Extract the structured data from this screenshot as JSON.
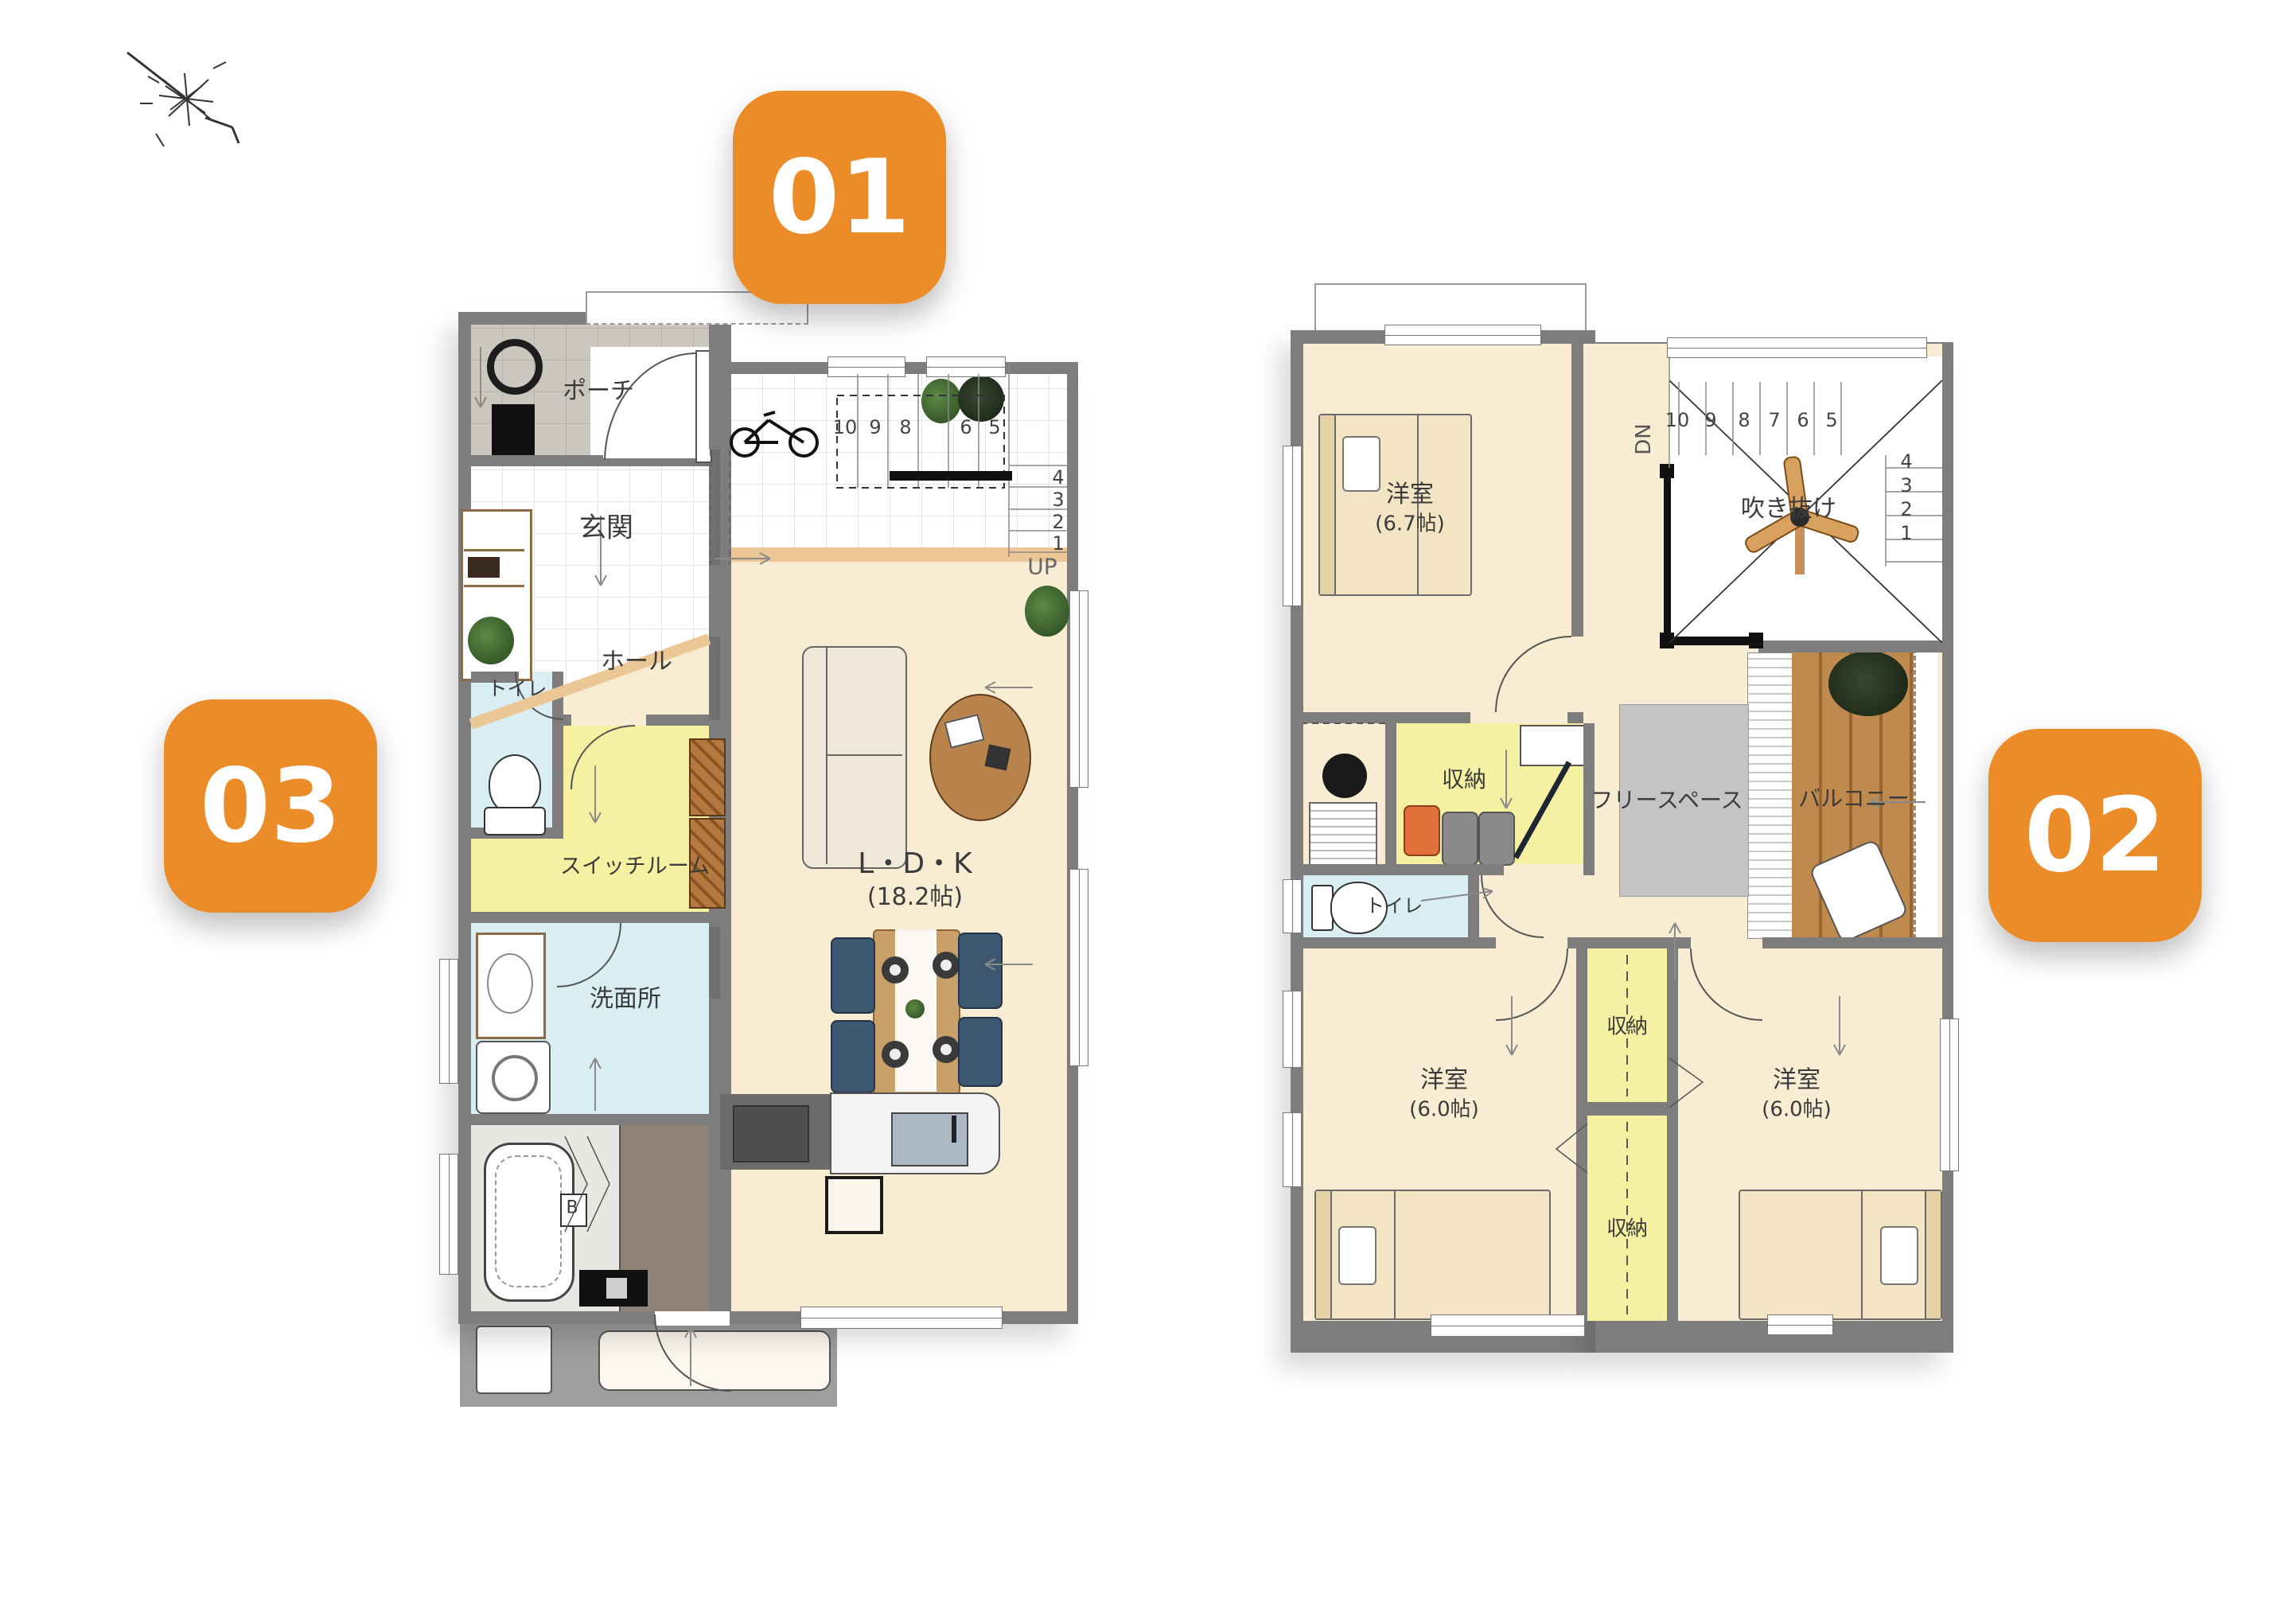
{
  "badges": {
    "b1": "01",
    "b2": "02",
    "b3": "03"
  },
  "f1": {
    "porch": "ポーチ",
    "genkan": "玄関",
    "hall": "ホール",
    "toilet": "トイレ",
    "switch": "スイッチルーム",
    "wash": "洗面所",
    "ldk": "L・D・K",
    "ldk_size": "(18.2帖)",
    "bath_b": "B",
    "up": "UP",
    "n1": [
      "10",
      "9",
      "8",
      "6",
      "5"
    ],
    "n2": [
      "4",
      "3",
      "2",
      "1"
    ]
  },
  "f2": {
    "bed1": "洋室",
    "bed1_size": "(6.7帖)",
    "void": "吹き抜け",
    "dn": "DN",
    "closet": "収納",
    "free": "フリースペース",
    "balcony": "バルコニー",
    "toilet": "トイレ",
    "bed2": "洋室",
    "bed2_size": "(6.0帖)",
    "bed3": "洋室",
    "bed3_size": "(6.0帖)",
    "closet_top": "収納",
    "closet_bottom": "収納",
    "n1": [
      "10",
      "9",
      "8",
      "7",
      "6",
      "5"
    ],
    "n2": [
      "4",
      "3",
      "2",
      "1"
    ]
  },
  "colors": {
    "accent": "#EC8C28",
    "wall": "#7D7D7D",
    "cream": "#F8EDD2",
    "yellow": "#F6F0A2",
    "blue": "#D9EEF2",
    "deck": "#C08A4E",
    "rug": "#C4C4C4"
  }
}
